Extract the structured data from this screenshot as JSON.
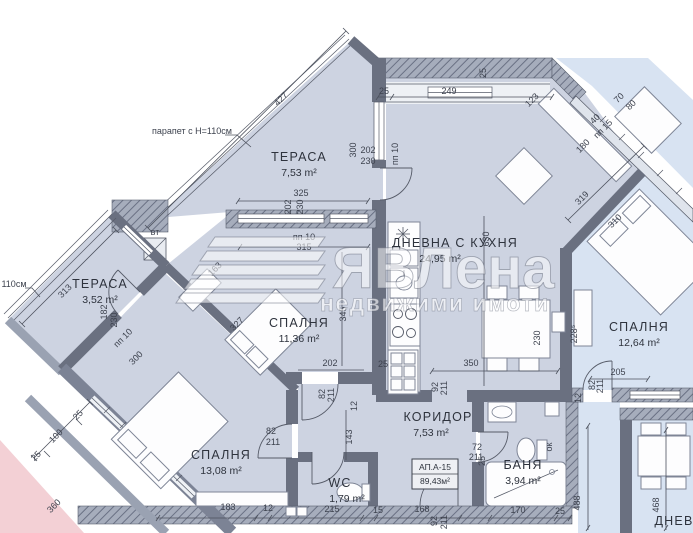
{
  "colors": {
    "room_fill": "#cdd3e1",
    "neighbor_fill": "#d8e3f2",
    "neighbor_pink": "#f3d0d5",
    "wall": "#6a7080",
    "dim_text": "#3d424e",
    "label_text": "#2e333d"
  },
  "watermark": {
    "brand": "ЯВЛена",
    "tagline": "недвижими имоти"
  },
  "apartment_box": {
    "line1": "АП.А-15",
    "line2": "89,43м²"
  },
  "rooms": [
    {
      "name": "ТЕРАСА",
      "area": "7,53 m²",
      "x": 299,
      "y": 161
    },
    {
      "name": "ТЕРАСА",
      "area": "3,52 m²",
      "x": 100,
      "y": 288
    },
    {
      "name": "ДНЕВНА С КУХНЯ",
      "area": "24,95 m²",
      "x": 455,
      "y": 247,
      "ax": 440
    },
    {
      "name": "СПАЛНЯ",
      "area": "11,36 m²",
      "x": 299,
      "y": 327
    },
    {
      "name": "СПАЛНЯ",
      "area": "12,64 m²",
      "x": 639,
      "y": 331
    },
    {
      "name": "СПАЛНЯ",
      "area": "13,08 m²",
      "x": 221,
      "y": 459
    },
    {
      "name": "КОРИДОР",
      "area": "7,53 m²",
      "x": 438,
      "y": 421,
      "ax": 431
    },
    {
      "name": "БАНЯ",
      "area": "3,94 m²",
      "x": 523,
      "y": 469
    },
    {
      "name": "WC",
      "area": "1,79 m²",
      "x": 340,
      "y": 487,
      "fs": 15,
      "ax": 347
    },
    {
      "name": "ДНЕВ",
      "x": 674,
      "y": 525,
      "fs": 14
    }
  ],
  "dims": [
    {
      "t": "парапет с Н=110см",
      "x": 192,
      "y": 134,
      "r": 0,
      "s": 8
    },
    {
      "t": "427",
      "x": 283,
      "y": 101,
      "r": -45
    },
    {
      "t": "25",
      "x": 384,
      "y": 94,
      "r": 0,
      "s": 8
    },
    {
      "t": "249",
      "x": 449,
      "y": 94,
      "r": 0
    },
    {
      "t": "25",
      "x": 486,
      "y": 73,
      "r": -90,
      "s": 8
    },
    {
      "t": "123",
      "x": 534,
      "y": 102,
      "r": -45
    },
    {
      "t": "70",
      "x": 621,
      "y": 100,
      "r": -45,
      "s": 8
    },
    {
      "t": "80",
      "x": 633,
      "y": 107,
      "r": -45,
      "s": 8
    },
    {
      "t": "40",
      "x": 597,
      "y": 121,
      "r": -45,
      "s": 8
    },
    {
      "t": "пп 15",
      "x": 605,
      "y": 131,
      "r": -45,
      "s": 7
    },
    {
      "t": "180",
      "x": 585,
      "y": 148,
      "r": -45
    },
    {
      "t": "319",
      "x": 584,
      "y": 200,
      "r": -45
    },
    {
      "t": "310",
      "x": 617,
      "y": 223,
      "r": -45,
      "s": 8
    },
    {
      "t": "300",
      "x": 356,
      "y": 150,
      "r": -90,
      "s": 8
    },
    {
      "t": "202",
      "x": 368,
      "y": 153,
      "r": 0,
      "s": 7
    },
    {
      "t": "230",
      "x": 368,
      "y": 164,
      "r": 0,
      "s": 7
    },
    {
      "t": "пп 10",
      "x": 398,
      "y": 154,
      "r": -90,
      "s": 7
    },
    {
      "t": "325",
      "x": 301,
      "y": 196,
      "r": 0
    },
    {
      "t": "202",
      "x": 291,
      "y": 207,
      "r": -90,
      "s": 7
    },
    {
      "t": "230",
      "x": 303,
      "y": 207,
      "r": -90,
      "s": 7
    },
    {
      "t": "пп 10",
      "x": 304,
      "y": 240,
      "r": 0,
      "s": 7
    },
    {
      "t": "315",
      "x": 304,
      "y": 250,
      "r": 0
    },
    {
      "t": "163",
      "x": 217,
      "y": 271,
      "r": -45,
      "s": 8
    },
    {
      "t": "вт",
      "x": 155,
      "y": 235,
      "r": 0,
      "s": 7
    },
    {
      "t": "110см",
      "x": 14,
      "y": 287,
      "r": 0,
      "s": 8
    },
    {
      "t": "313",
      "x": 67,
      "y": 293,
      "r": -45
    },
    {
      "t": "182",
      "x": 107,
      "y": 312,
      "r": -90,
      "s": 7
    },
    {
      "t": "230",
      "x": 117,
      "y": 320,
      "r": -90,
      "s": 7
    },
    {
      "t": "пп 10",
      "x": 125,
      "y": 340,
      "r": -45,
      "s": 7
    },
    {
      "t": "300",
      "x": 138,
      "y": 360,
      "r": -45
    },
    {
      "t": "327",
      "x": 239,
      "y": 326,
      "r": -45
    },
    {
      "t": "345",
      "x": 346,
      "y": 314,
      "r": -90,
      "s": 8
    },
    {
      "t": "630",
      "x": 489,
      "y": 239,
      "r": -90
    },
    {
      "t": "202",
      "x": 330,
      "y": 366,
      "r": 0
    },
    {
      "t": "25",
      "x": 383,
      "y": 367,
      "r": 0,
      "s": 7
    },
    {
      "t": "82",
      "x": 325,
      "y": 394,
      "r": -90,
      "s": 7
    },
    {
      "t": "211",
      "x": 334,
      "y": 395,
      "r": -90,
      "s": 7
    },
    {
      "t": "12",
      "x": 357,
      "y": 406,
      "r": -90,
      "s": 7
    },
    {
      "t": "143",
      "x": 352,
      "y": 437,
      "r": -90
    },
    {
      "t": "350",
      "x": 471,
      "y": 366,
      "r": 0
    },
    {
      "t": "92",
      "x": 438,
      "y": 387,
      "r": -90,
      "s": 7
    },
    {
      "t": "211",
      "x": 447,
      "y": 388,
      "r": -90,
      "s": 7
    },
    {
      "t": "230",
      "x": 540,
      "y": 338,
      "r": -90,
      "s": 8
    },
    {
      "t": "228⁵",
      "x": 577,
      "y": 334,
      "r": -90,
      "s": 8
    },
    {
      "t": "205",
      "x": 618,
      "y": 375,
      "r": 0
    },
    {
      "t": "82",
      "x": 595,
      "y": 385,
      "r": -90,
      "s": 7
    },
    {
      "t": "211",
      "x": 603,
      "y": 386,
      "r": -90,
      "s": 7
    },
    {
      "t": "12",
      "x": 581,
      "y": 398,
      "r": -90,
      "s": 7
    },
    {
      "t": "82",
      "x": 271,
      "y": 434,
      "r": 0,
      "s": 7
    },
    {
      "t": "211",
      "x": 273,
      "y": 445,
      "r": 0,
      "s": 7
    },
    {
      "t": "72",
      "x": 477,
      "y": 450,
      "r": 0,
      "s": 7
    },
    {
      "t": "211",
      "x": 476,
      "y": 460,
      "r": 0,
      "s": 7
    },
    {
      "t": "25",
      "x": 485,
      "y": 461,
      "r": -90,
      "s": 7
    },
    {
      "t": "ок",
      "x": 552,
      "y": 447,
      "r": -90,
      "s": 7
    },
    {
      "t": "25",
      "x": 80,
      "y": 417,
      "r": -45,
      "s": 8
    },
    {
      "t": "100",
      "x": 58,
      "y": 438,
      "r": -45
    },
    {
      "t": "25",
      "x": 38,
      "y": 458,
      "r": -45,
      "s": 8
    },
    {
      "t": "360",
      "x": 56,
      "y": 508,
      "r": -45
    },
    {
      "t": "183",
      "x": 228,
      "y": 510,
      "r": 0
    },
    {
      "t": "12",
      "x": 268,
      "y": 511,
      "r": 0,
      "s": 8
    },
    {
      "t": "215",
      "x": 332,
      "y": 512,
      "r": 0
    },
    {
      "t": "15",
      "x": 378,
      "y": 513,
      "r": 0,
      "s": 8
    },
    {
      "t": "168",
      "x": 422,
      "y": 512,
      "r": 0
    },
    {
      "t": "92",
      "x": 437,
      "y": 521,
      "r": -90,
      "s": 7
    },
    {
      "t": "211",
      "x": 447,
      "y": 522,
      "r": -90,
      "s": 7
    },
    {
      "t": "170",
      "x": 518,
      "y": 513,
      "r": 0
    },
    {
      "t": "25",
      "x": 560,
      "y": 514,
      "r": 0,
      "s": 8
    },
    {
      "t": "488",
      "x": 580,
      "y": 503,
      "r": -90
    },
    {
      "t": "468",
      "x": 659,
      "y": 505,
      "r": -90
    }
  ]
}
